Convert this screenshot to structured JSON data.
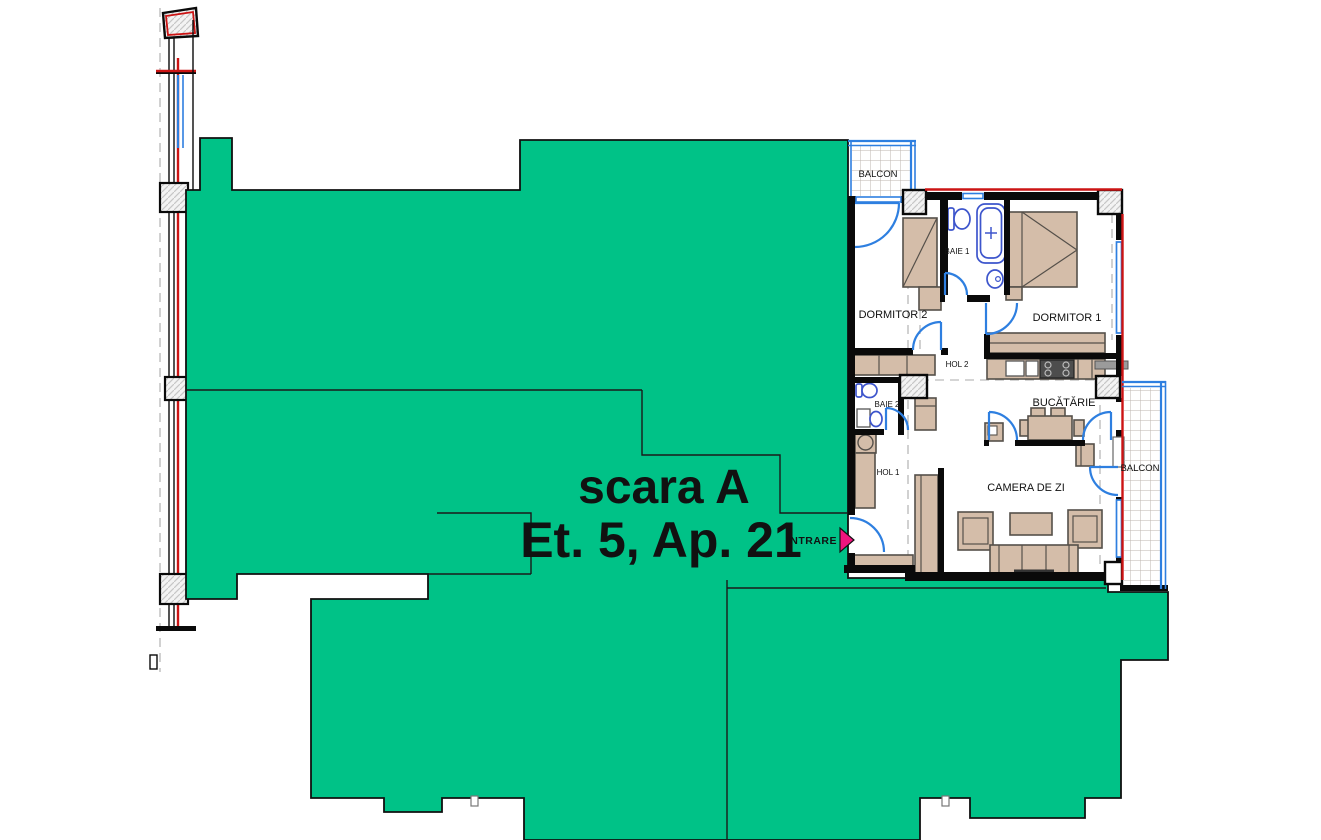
{
  "plan": {
    "masked": {
      "title_line1": "scara A",
      "title_line2": "Et. 5, Ap. 21"
    },
    "entrance": {
      "label": "INTRARE"
    },
    "rooms": {
      "balcon_top": "BALCON",
      "dormitor2": "DORMITOR 2",
      "baie1": "BAIE 1",
      "dormitor1": "DORMITOR 1",
      "hol2": "HOL 2",
      "baie2": "BAIE 2",
      "bucatarie": "BUCĂTĂRIE",
      "hol1": "HOL 1",
      "camera_de_zi": "CAMERA DE ZI",
      "balcon_right": "BALCON"
    },
    "colors": {
      "mask_green": "#00c287",
      "wall_black": "#0a0a0a",
      "door_blue": "#2e7fe0",
      "fixture_blue": "#3d55cc",
      "furniture_tan": "#d4bda9",
      "furniture_border": "#55504a",
      "accent_red": "#cc1414",
      "entrance_magenta": "#f0147e",
      "guide_gray": "#ababab"
    }
  }
}
